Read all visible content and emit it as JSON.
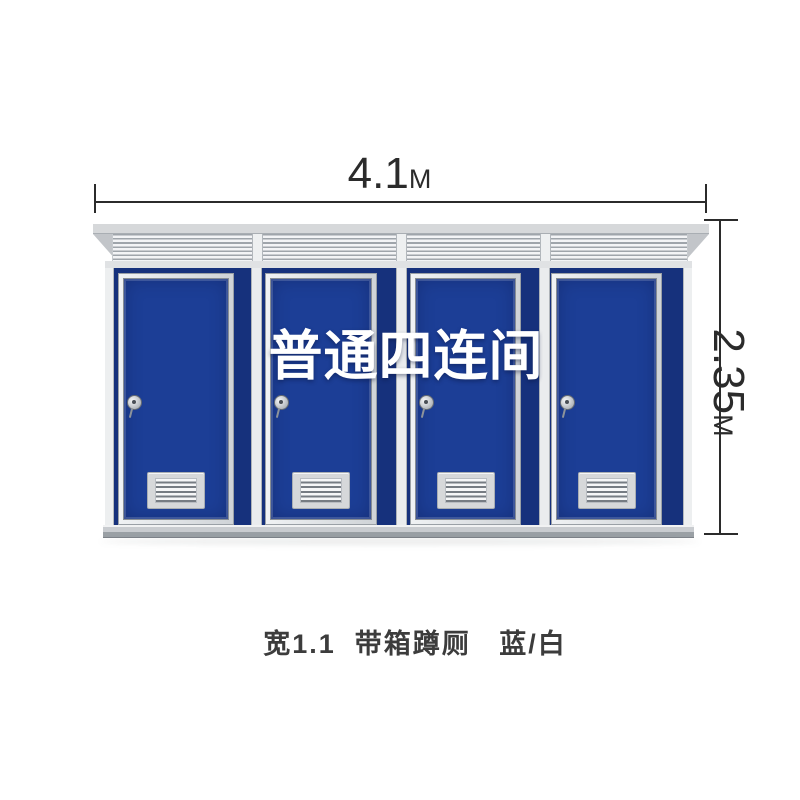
{
  "annotations": {
    "width_value": "4.1",
    "width_unit": "M",
    "height_value": "2.35",
    "height_unit": "M",
    "watermark": "普通四连间",
    "caption": "宽1.1  带箱蹲厕   蓝/白"
  },
  "building": {
    "door_count": 4,
    "style": "blue/white"
  },
  "colors": {
    "background": "#ffffff",
    "door-blue": "#1c3e96",
    "wall-blue": "#16317c",
    "roof-gray": "#d6d8da",
    "dim-color": "#2b2b2b",
    "caption-color": "#3c3c3c",
    "watermark-white": "#ffffff"
  }
}
